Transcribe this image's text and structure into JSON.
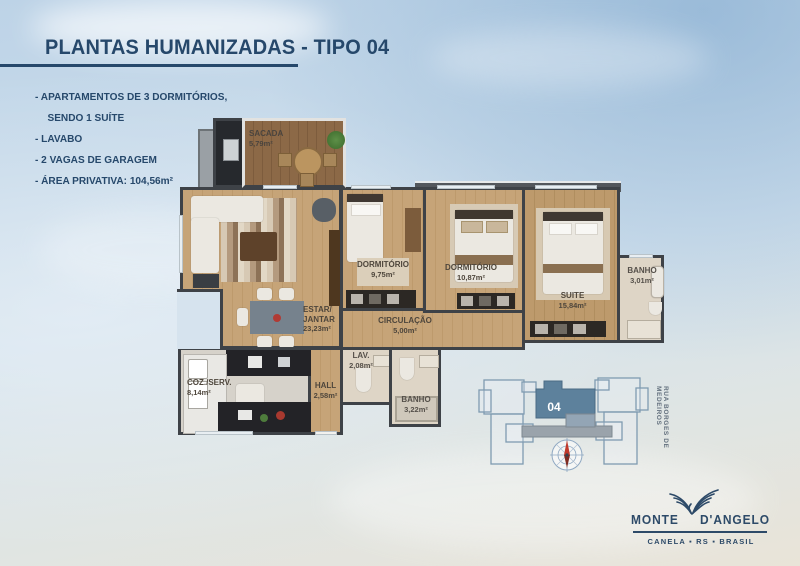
{
  "header": {
    "title": "PLANTAS HUMANIZADAS - TIPO 04"
  },
  "features": [
    "- APARTAMENTOS DE 3 DORMITÓRIOS,",
    "SENDO 1 SUÍTE",
    "- LAVABO",
    "- 2 VAGAS DE GARAGEM",
    "- ÁREA PRIVATIVA: 104,56m²"
  ],
  "floorplan": {
    "rooms": {
      "sacada": {
        "name": "SACADA",
        "area": "5,79m²"
      },
      "estar": {
        "name1": "ESTAR/",
        "name2": "JANTAR",
        "area": "23,23m²"
      },
      "dorm1": {
        "name": "DORMITÓRIO",
        "area": "9,75m²"
      },
      "dorm2": {
        "name": "DORMITÓRIO",
        "area": "10,87m²"
      },
      "suite": {
        "name": "SUITE",
        "area": "15,84m²"
      },
      "banho_suite": {
        "name": "BANHO",
        "area": "3,01m²"
      },
      "circulacao": {
        "name": "CIRCULAÇÃO",
        "area": "5,00m²"
      },
      "lav": {
        "name": "LAV.",
        "area": "2,08m²"
      },
      "banho": {
        "name": "BANHO",
        "area": "3,22m²"
      },
      "cozinha": {
        "name": "COZ./SERV.",
        "area": "8,14m²"
      },
      "hall": {
        "name": "HALL",
        "area": "2,58m²"
      }
    }
  },
  "site_plan": {
    "unit": "04",
    "street": "RUA BORGES DE MEDEIROS"
  },
  "logo": {
    "name_left": "MONTE",
    "name_right": "D'ANGELO",
    "location": "CANELA ▪ RS ▪ BRASIL"
  },
  "colors": {
    "accent_navy": "#26486b",
    "wall": "#3e4247",
    "wood_floor": "#c6a478",
    "deck_wood": "#8c6947",
    "unit_highlight": "#5d819c",
    "site_outline": "#7f9bb1",
    "compass_needle": "#c0392b"
  }
}
